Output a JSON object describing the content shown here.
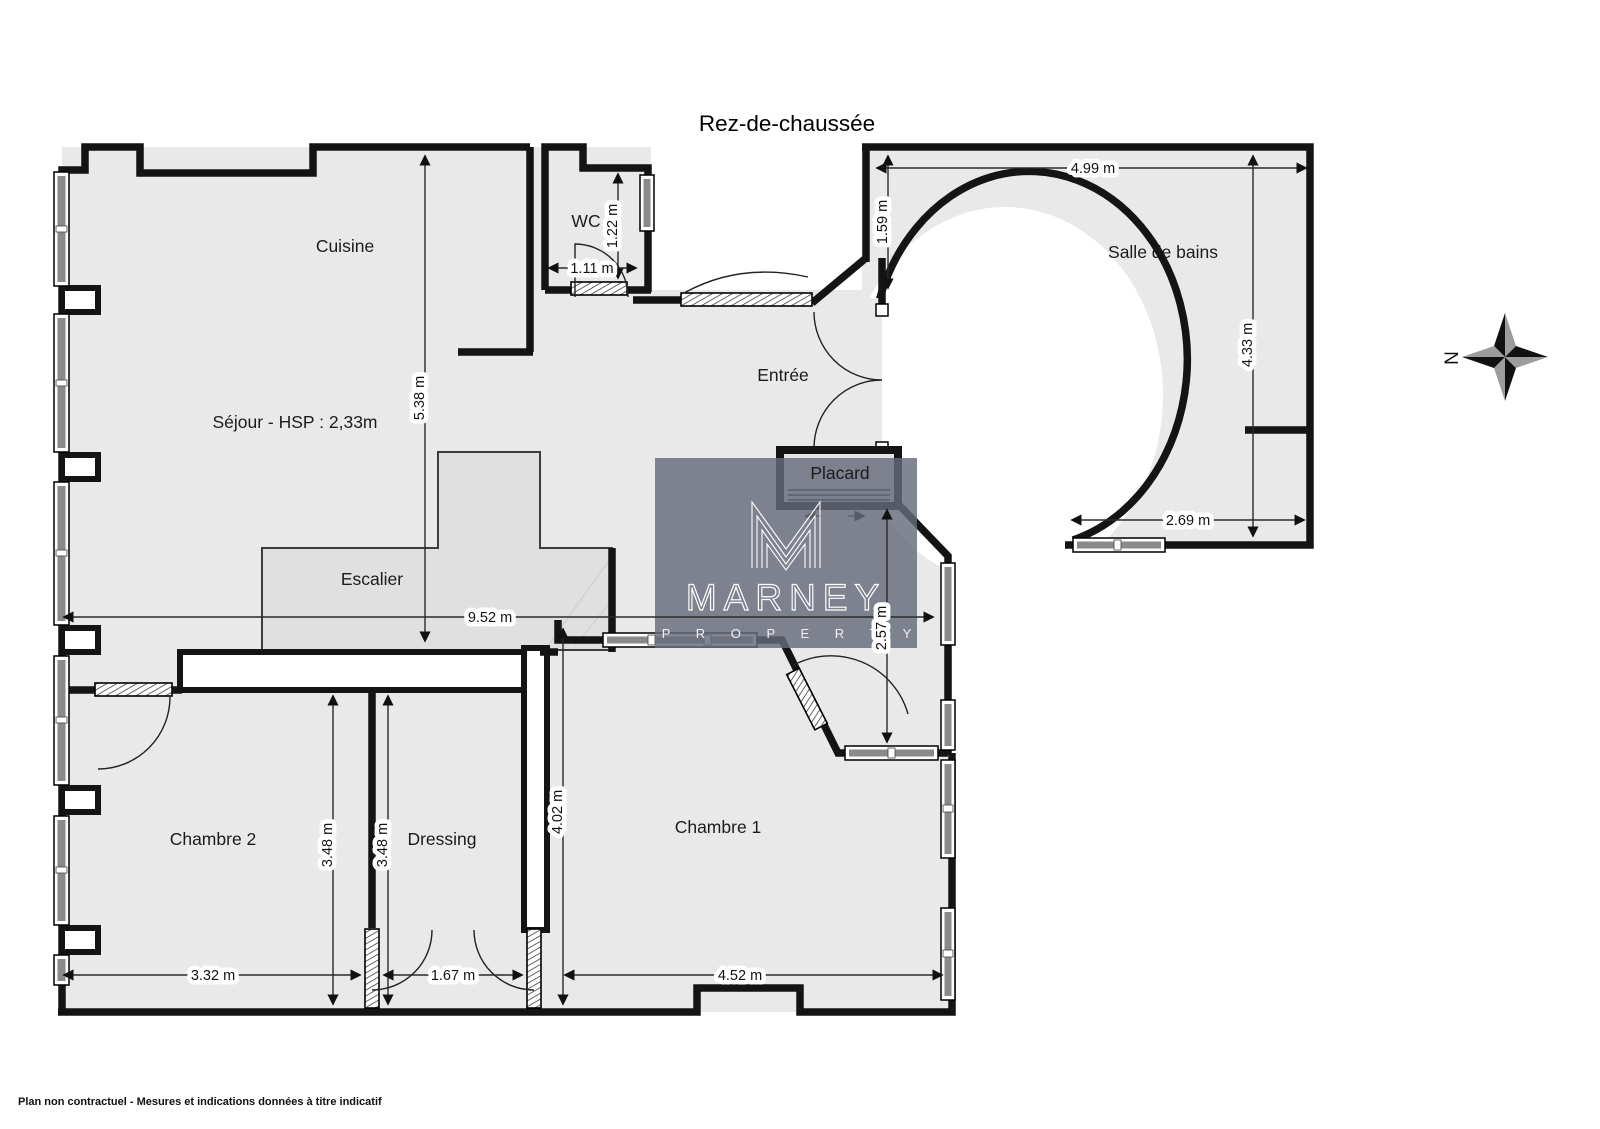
{
  "title": "Rez-de-chaussée",
  "rooms": {
    "cuisine": "Cuisine",
    "wc": "WC",
    "sejour": "Séjour - HSP : 2,33m",
    "entree": "Entrée",
    "salle_de_bains": "Salle de bains",
    "placard": "Placard",
    "escalier": "Escalier",
    "chambre1": "Chambre 1",
    "chambre2": "Chambre 2",
    "dressing": "Dressing"
  },
  "dimensions": {
    "sejour_height": "5.38 m",
    "wc_height": "1.22 m",
    "wc_width": "1.11 m",
    "bains_top_width": "4.99 m",
    "bains_entry_height": "1.59 m",
    "bains_height": "4.33 m",
    "bains_bottom_width": "2.69 m",
    "sejour_width": "9.52 m",
    "couloir_height": "2.57 m",
    "chambre1_height": "4.02 m",
    "chambre2_height": "3.48 m",
    "dressing_height": "3.48 m",
    "chambre2_width": "3.32 m",
    "dressing_width": "1.67 m",
    "chambre1_width": "4.52 m"
  },
  "watermark": {
    "name": "MARNEY",
    "subtitle": "P R O P E R T Y"
  },
  "compass": {
    "north": "N"
  },
  "footer": "Plan non contractuel - Mesures et indications données à titre indicatif",
  "colors": {
    "floor": "#e9e9e9",
    "wall": "#141414",
    "watermark": "rgba(103,107,122,0.82)"
  }
}
